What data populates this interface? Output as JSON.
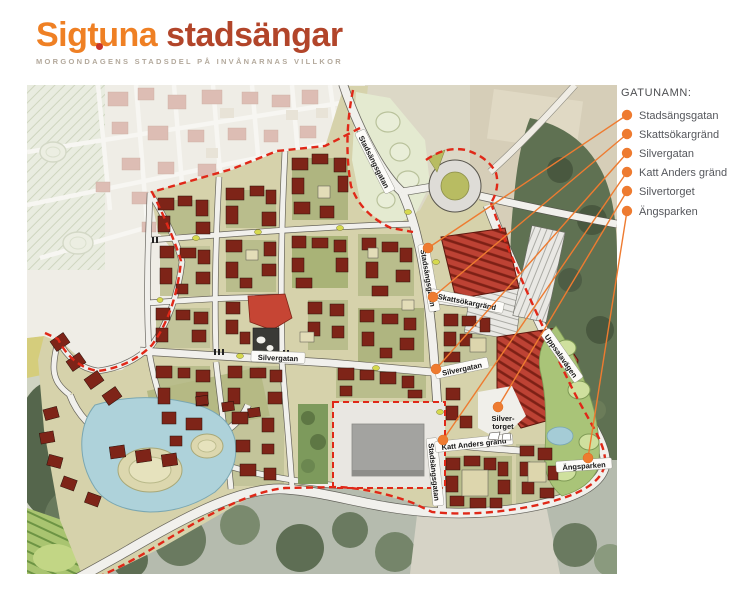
{
  "header": {
    "brand_primary": "Sigtuna",
    "brand_secondary": "stadsängar",
    "tagline": "MORGONDAGENS STADSDEL PÅ INVÅNARNAS VILLKOR"
  },
  "legend": {
    "title": "GATUNAMN:",
    "items": [
      {
        "label": "Stadsängsgatan"
      },
      {
        "label": "Skattsökargränd"
      },
      {
        "label": "Silvergatan"
      },
      {
        "label": "Katt Anders gränd"
      },
      {
        "label": "Silvertorget"
      },
      {
        "label": "Ängsparken"
      }
    ]
  },
  "map_labels": {
    "stadsangsgatan": "Stadsängsgatan",
    "skattsokargrand": "Skattsökargränd",
    "silvergatan": "Silvergatan",
    "katt_anders_grand": "Katt Anders gränd",
    "silvertorget_line1": "Silver-",
    "silvertorget_line2": "torget",
    "angsparken": "Ängsparken",
    "uppsalavagen": "Uppsalavägen"
  },
  "colors": {
    "accent_orange": "#EE7B30",
    "boundary_red": "#E02818",
    "building_red": "#7E2418",
    "logo_orange": "#EF8024",
    "logo_dark_red": "#B2452A"
  }
}
